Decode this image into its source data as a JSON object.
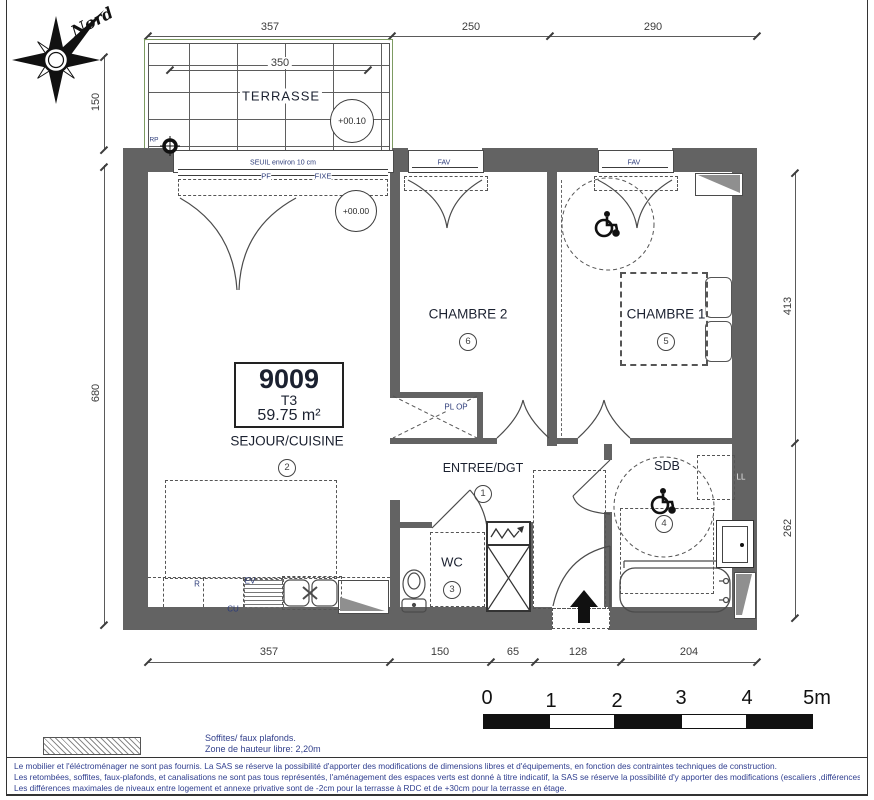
{
  "north_label": "Nord",
  "title_block": {
    "lot": "9009",
    "type": "T3",
    "area": "59.75 m²"
  },
  "rooms": {
    "terrasse": {
      "label": "TERRASSE"
    },
    "sejour": {
      "label": "SEJOUR/CUISINE",
      "num": "2"
    },
    "entree": {
      "label": "ENTREE/DGT",
      "num": "1"
    },
    "wc": {
      "label": "WC",
      "num": "3"
    },
    "sdb": {
      "label": "SDB",
      "num": "4"
    },
    "chambre1": {
      "label": "CHAMBRE 1",
      "num": "5"
    },
    "chambre2": {
      "label": "CHAMBRE 2",
      "num": "6"
    }
  },
  "levels": {
    "terrace": "+00.10",
    "interior": "+00.00"
  },
  "annotations": {
    "seuil": "SEUIL environ 10 cm",
    "pf": "PF",
    "fixe": "FIXE",
    "fav": "FAV",
    "pl_op": "PL OP",
    "ll": "LL",
    "rp": "RP",
    "fridge": "R",
    "cook": "CU",
    "sink": "EV"
  },
  "dimensions": {
    "top": [
      "357",
      "250",
      "290"
    ],
    "bottom": [
      "357",
      "150",
      "65",
      "128",
      "204"
    ],
    "left": [
      "150",
      "680"
    ],
    "right": [
      "413",
      "262"
    ],
    "terrace_width": "350"
  },
  "scale_bar": {
    "labels": [
      "0",
      "1",
      "2",
      "3",
      "4",
      "5m"
    ]
  },
  "legend": {
    "line1": "Soffites/ faux plafonds.",
    "line2": "Zone de hauteur libre: 2,20m"
  },
  "disclaimer": {
    "line1": "Le mobilier et l'éléctroménager ne sont pas fournis. La SAS se réserve la possibilité d'apporter des modifications de dimensions libres et d'équipements, en fonction des contraintes techniques de construction.",
    "line2": "Les retombées, soffites, faux-plafonds, et canalisations ne sont pas tous représentés, l'aménagement des espaces verts est donné à titre indicatif, la SAS se réserve la possibilité d'y apporter des modifications (escaliers ,différences de niveaux) .",
    "line3": "Les différences maximales de niveaux entre logement et annexe privative sont de -2cm pour la terrasse à RDC et de +30cm pour la terrasse en étage."
  },
  "colors": {
    "wall": "#636363",
    "ink": "#1b2130",
    "annotation": "#2d3c7a",
    "legal": "#2f3e8f"
  }
}
